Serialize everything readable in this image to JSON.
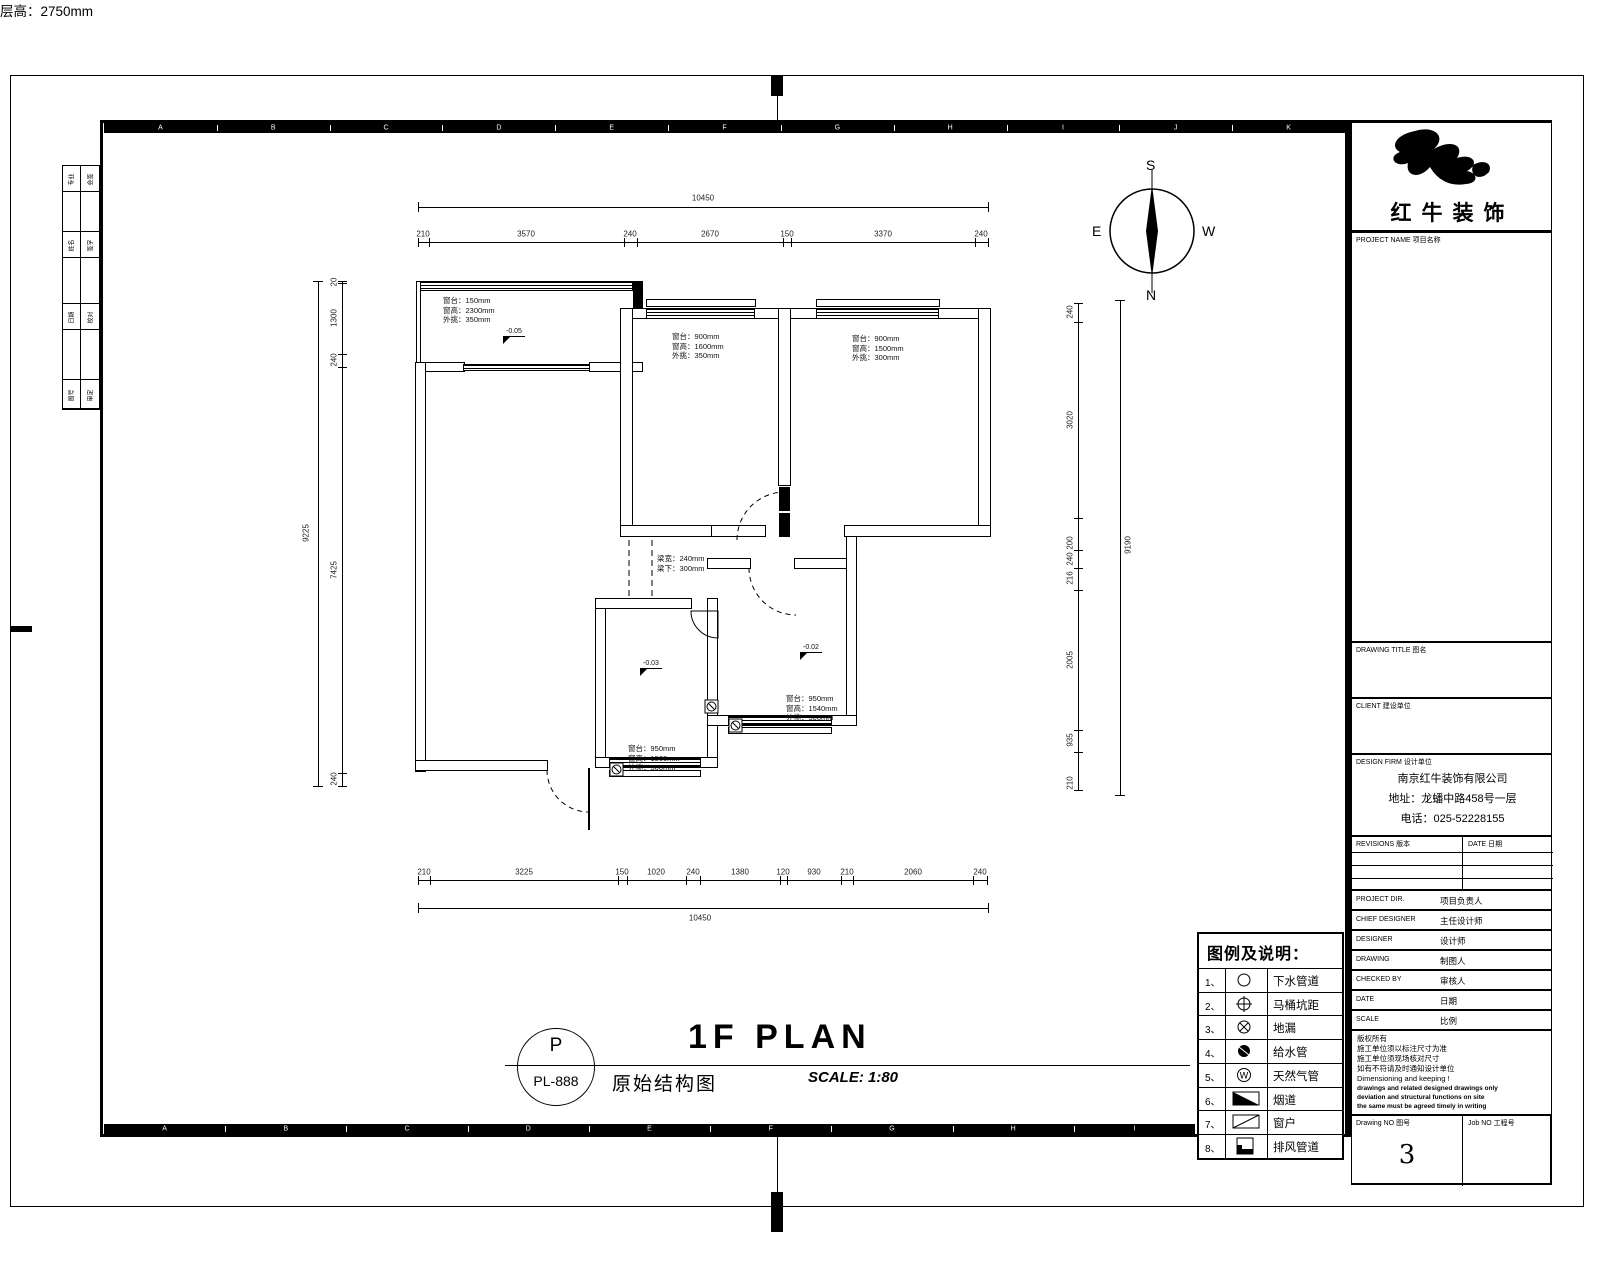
{
  "sheet": {
    "band_letters": [
      "A",
      "B",
      "C",
      "D",
      "E",
      "F",
      "G",
      "H",
      "I",
      "J",
      "K"
    ]
  },
  "compass": {
    "top": "S",
    "bottom": "N",
    "left": "E",
    "right": "W"
  },
  "plan": {
    "living": {
      "height_note": "层高：2750mm"
    },
    "balcony": {
      "level": "-0.05",
      "notes": [
        "窗台：150mm",
        "窗高：2300mm",
        "外挑：350mm"
      ]
    },
    "bedroom_mid": {
      "notes": [
        "窗台：900mm",
        "窗高：1600mm",
        "外挑：350mm"
      ]
    },
    "bedroom_right": {
      "notes": [
        "窗台：900mm",
        "窗高：1500mm",
        "外挑：300mm"
      ]
    },
    "kitchen": {
      "level": "-0.03",
      "notes": [
        "窗台：950mm",
        "窗高：1500mm",
        "外挑：300mm"
      ]
    },
    "bathroom": {
      "level": "-0.02",
      "notes": [
        "窗台：950mm",
        "窗高：1540mm",
        "外挑：300mm"
      ]
    },
    "beam_note": [
      "梁宽：240mm",
      "梁下：300mm"
    ],
    "dims": {
      "top": {
        "total": "10450",
        "segments": [
          "210",
          "3570",
          "240",
          "2670",
          "150",
          "3370",
          "240"
        ]
      },
      "bottom": {
        "total": "10450",
        "segments": [
          "210",
          "3225",
          "150",
          "1020",
          "240",
          "1380",
          "120",
          "930",
          "210",
          "2060",
          "240"
        ]
      },
      "left": {
        "total": "9225",
        "segments": [
          "20",
          "1300",
          "240",
          "7425",
          "240"
        ]
      },
      "right": {
        "total": "9190",
        "segments": [
          "240",
          "3020",
          "200",
          "240",
          "216",
          "2005",
          "935",
          "210"
        ]
      }
    }
  },
  "legend": {
    "title": "图例及说明：",
    "rows": [
      {
        "num": "1、",
        "sym": "circle",
        "label": "下水管道"
      },
      {
        "num": "2、",
        "sym": "circle-cross",
        "label": "马桶坑距"
      },
      {
        "num": "3、",
        "sym": "circle-x",
        "label": "地漏"
      },
      {
        "num": "4、",
        "sym": "circle-fill",
        "label": "给水管"
      },
      {
        "num": "5、",
        "sym": "circle-m",
        "label": "天然气管"
      },
      {
        "num": "6、",
        "sym": "rect-tri",
        "label": "烟道"
      },
      {
        "num": "7、",
        "sym": "rect-diag",
        "label": "窗户"
      },
      {
        "num": "8、",
        "sym": "rect-corner",
        "label": "排风管道"
      }
    ]
  },
  "footer": {
    "bubble_top": "P",
    "bubble_bottom": "PL-888",
    "title_en": "1F PLAN",
    "title_cn": "原始结构图",
    "scale": "SCALE: 1:80"
  },
  "title_block": {
    "brand": "红牛装饰",
    "project_label": "PROJECT NAME 项目名称",
    "drawing_title_label": "DRAWING TITLE 图名",
    "client_label": "CLIENT 建设单位",
    "design_firm_label": "DESIGN FIRM 设计单位",
    "firm_lines": [
      "南京红牛装饰有限公司",
      "地址：龙蟠中路458号一层",
      "电话：025-52228155"
    ],
    "revisions_label": "REVISIONS 版本",
    "date_label": "DATE 日期",
    "personnel": [
      {
        "en": "PROJECT DIR.",
        "cn": "项目负责人"
      },
      {
        "en": "CHIEF DESIGNER",
        "cn": "主任设计师"
      },
      {
        "en": "DESIGNER",
        "cn": "设计师"
      },
      {
        "en": "DRAWING",
        "cn": "制图人"
      },
      {
        "en": "CHECKED BY",
        "cn": "审核人"
      },
      {
        "en": "DATE",
        "cn": "日期"
      },
      {
        "en": "SCALE",
        "cn": "比例"
      }
    ],
    "notes": [
      "版权所有",
      "施工单位须以标注尺寸为准",
      "施工单位须现场核对尺寸",
      "如有不符请及时通知设计单位",
      "Dimensioning and keeping !"
    ],
    "notes_bold": [
      "drawings and related designed drawings only",
      "deviation and structural functions on site",
      "the same must be agreed timely in writing"
    ],
    "drawing_no_label": "Drawing NO 图号",
    "drawing_no_value": "3",
    "job_no_label": "Job NO 工程号"
  },
  "binding_strip": {
    "col1": [
      "专业",
      "姓名",
      "日期",
      "图号"
    ],
    "col2": [
      "会签",
      "签字",
      "校对",
      "审定"
    ]
  }
}
